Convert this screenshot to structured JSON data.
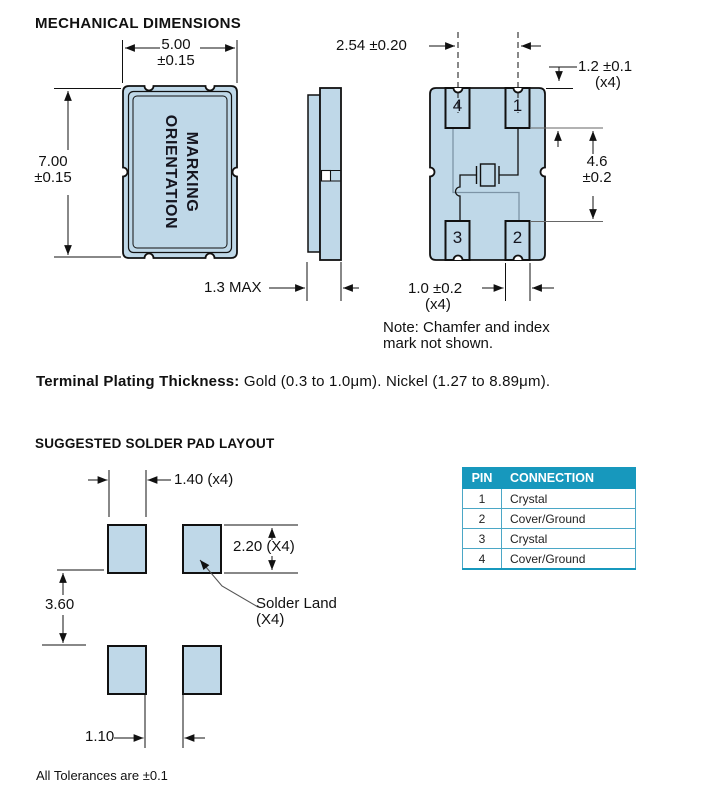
{
  "title": "MECHANICAL DIMENSIONS",
  "top_view": {
    "width_value": "5.00",
    "width_tol": "±0.15",
    "height_value": "7.00",
    "height_tol": "±0.15",
    "marking_line1": "MARKING",
    "marking_line2": "ORIENTATION"
  },
  "side_view": {
    "thickness": "1.3 MAX"
  },
  "bottom_view": {
    "pitch": "2.54 ±0.20",
    "pad_width_top": "1.2 ±0.1",
    "pad_width_top_qty": "(x4)",
    "span_value": "4.6",
    "span_tol": "±0.2",
    "pad_width_bottom": "1.0 ±0.2",
    "pad_width_bottom_qty": "(x4)",
    "pads": [
      "4",
      "1",
      "3",
      "2"
    ],
    "note_line1": "Note: Chamfer and index",
    "note_line2": "mark not shown."
  },
  "plating_label": "Terminal Plating Thickness:",
  "plating_text": " Gold (0.3 to 1.0μm). Nickel (1.27 to 8.89μm).",
  "solder_layout": {
    "heading": "SUGGESTED SOLDER PAD LAYOUT",
    "pad_width": "1.40 (x4)",
    "pad_height": "2.20 (X4)",
    "row_gap": "3.60",
    "col_gap": "1.10",
    "land_line1": "Solder Land",
    "land_line2": "(X4)"
  },
  "pin_table": {
    "headers": [
      "PIN",
      "CONNECTION"
    ],
    "rows": [
      {
        "pin": "1",
        "connection": "Crystal"
      },
      {
        "pin": "2",
        "connection": "Cover/Ground"
      },
      {
        "pin": "3",
        "connection": "Crystal"
      },
      {
        "pin": "4",
        "connection": "Cover/Ground"
      }
    ]
  },
  "footnote": "All Tolerances are ±0.1",
  "colors": {
    "body_fill": "#BFD8E8",
    "line": "#111111",
    "table_header_bg": "#1798BD"
  }
}
